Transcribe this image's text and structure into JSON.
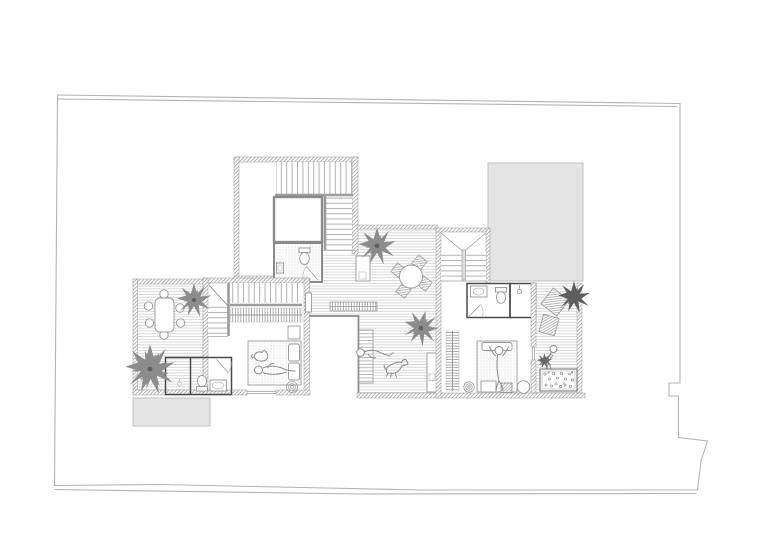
{
  "document": {
    "kind": "architectural-floor-plan",
    "visible_text": "none"
  },
  "colors": {
    "background": "#ffffff",
    "boundary_line": "#b4b4b4",
    "wall_hatch": "#8e8e8e",
    "wall_dark": "#4a4a4a",
    "deck_line": "#d5d5d5",
    "roof_fill": "#e4e4e4",
    "roof_border": "#bcbcbc",
    "furniture_line": "#979797",
    "figure_line": "#8a8a8a",
    "plant_fill": "#8c8c8c",
    "plant_dark": "#5f5f5f",
    "stair_tread": "#b3b3b3",
    "void_edge": "#8a8a8a"
  },
  "plan": {
    "site": {
      "boundary": "irregular-plot-outline-double-line",
      "notch": "small-rect-notch-right-edge",
      "jog": "stepped-corner-bottom-right"
    },
    "roof_patches": [
      {
        "name": "grey-roof-upper-right"
      },
      {
        "name": "grey-roof-lower-left"
      }
    ],
    "rooms": [
      {
        "name": "tower-stair-hall",
        "features": [
          "l-shaped-stair",
          "void-box",
          "wc-with-toilet-and-basin",
          "side-room"
        ]
      },
      {
        "name": "left-roof-terrace",
        "features": [
          "decking",
          "oval-dining-table",
          "six-chairs",
          "two-palms"
        ]
      },
      {
        "name": "left-bathroom",
        "features": [
          "shower-cell",
          "toilet",
          "basin",
          "swing-door"
        ]
      },
      {
        "name": "left-bedroom",
        "features": [
          "l-stair-with-break-line",
          "wardrobe-hanger-rail",
          "double-bed",
          "sleeping-person",
          "cat",
          "spiral-mat",
          "bedside-unit"
        ]
      },
      {
        "name": "middle-roof-terrace",
        "features": [
          "decking",
          "round-table-four-chairs",
          "slatted-bench",
          "sun-lounger",
          "lying-person",
          "dog",
          "two-palms",
          "planter-box",
          "wall-unit"
        ]
      },
      {
        "name": "open-void-gap",
        "features": [
          "white-gap-between-wings"
        ]
      },
      {
        "name": "right-stair-room",
        "features": [
          "dog-leg-stair-with-cross-lines"
        ]
      },
      {
        "name": "right-bathroom",
        "features": [
          "basin",
          "toilet",
          "swing-door"
        ]
      },
      {
        "name": "right-shower-room",
        "features": [
          "shower-head-symbol"
        ]
      },
      {
        "name": "right-bedroom",
        "features": [
          "wardrobe-hanger-rail",
          "single-bed",
          "person-arms-raised",
          "spiral-mat",
          "round-stool",
          "foot-bench"
        ]
      },
      {
        "name": "right-roof-terrace",
        "features": [
          "decking",
          "two-angled-rugs",
          "dark-shrub",
          "gardening-person",
          "flower-bed"
        ]
      }
    ],
    "figures": [
      "person-on-left-bed",
      "cat-on-left-bed",
      "person-on-lounger",
      "dog-walking",
      "person-on-right-bed",
      "person-gardening"
    ],
    "plant_count": 6
  }
}
